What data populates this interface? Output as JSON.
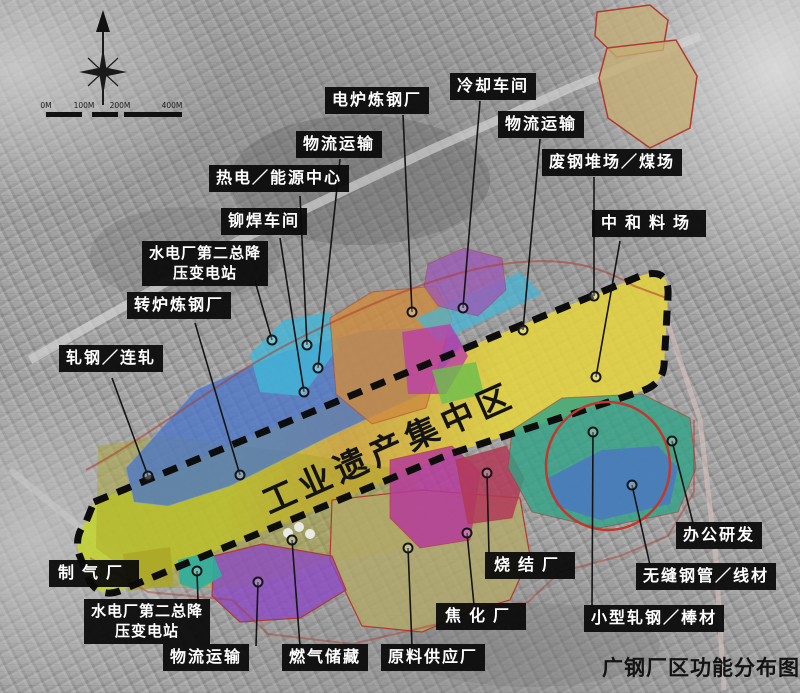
{
  "map": {
    "title": "广钢厂区功能分布图",
    "central_zone_label": "工业遗产集中区",
    "scale_bar": {
      "ticks": [
        "0M",
        "100M",
        "200M",
        "400M"
      ]
    },
    "labels": [
      {
        "id": "electric-furnace-steel-plant",
        "text": "电炉炼钢厂"
      },
      {
        "id": "cooling-workshop",
        "text": "冷却车间"
      },
      {
        "id": "logistics-transport-upper",
        "text": "物流运输"
      },
      {
        "id": "logistics-transport-right",
        "text": "物流运输"
      },
      {
        "id": "thermal-power-energy-center",
        "text": "热电／能源中心"
      },
      {
        "id": "scrap-steel-yard-coal-yard",
        "text": "废钢堆场／煤场"
      },
      {
        "id": "riveting-welding-workshop",
        "text": "铆焊车间"
      },
      {
        "id": "neutralization-stockyard",
        "text": "中和料场"
      },
      {
        "id": "hydropower-substation-upper",
        "text": "水电厂第二总降\n压变电站"
      },
      {
        "id": "converter-steel-plant",
        "text": "转炉炼钢厂"
      },
      {
        "id": "rolling-continuous-mill",
        "text": "轧钢／连轧"
      },
      {
        "id": "gas-making-plant",
        "text": "制气厂"
      },
      {
        "id": "hydropower-substation-lower",
        "text": "水电厂第二总降\n压变电站"
      },
      {
        "id": "logistics-transport-lower",
        "text": "物流运输"
      },
      {
        "id": "gas-storage",
        "text": "燃气储藏"
      },
      {
        "id": "raw-material-supply-plant",
        "text": "原料供应厂"
      },
      {
        "id": "coking-plant",
        "text": "焦化厂"
      },
      {
        "id": "sintering-plant",
        "text": "烧结厂"
      },
      {
        "id": "office-research",
        "text": "办公研发"
      },
      {
        "id": "seamless-pipe-wire",
        "text": "无缝钢管／线材"
      },
      {
        "id": "small-rolling-bar",
        "text": "小型轧钢／棒材"
      }
    ],
    "colors": {
      "strip_gradient": [
        "#c2d42c",
        "#cdd832",
        "#d2a63a",
        "#ddc03a",
        "#e6d63c",
        "#e6d43e"
      ],
      "boundary_dash": "#0d0d0d",
      "annotation_red": "#c0392b",
      "tan_north": "#c4ae74",
      "purple_top": "#9b59b6",
      "orange_plant": "#cd8b3f",
      "cyan_plant": "#41b7d8",
      "blue_rolling": "#4a76c8",
      "magenta_mid": "#bb3fa8",
      "green_patch": "#6abf4b",
      "olive_gas": "#a8a424",
      "teal_substation": "#2fae9e",
      "purple_logistics": "#8a46c4",
      "khaki_materials": "#b3a968",
      "magenta_storage": "#b5399a",
      "crimson_sinter": "#b23a58",
      "teal_office": "#2fa384",
      "blue_mill": "#4a78c0"
    }
  }
}
